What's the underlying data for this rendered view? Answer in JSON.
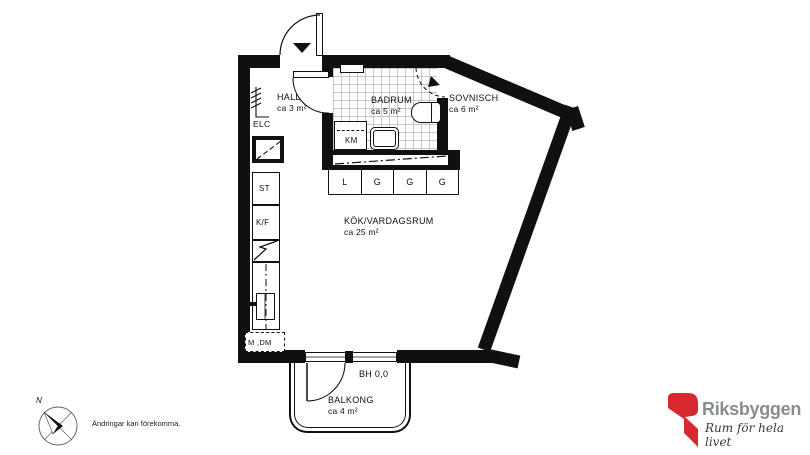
{
  "rooms": {
    "hall": {
      "name": "HALL",
      "area": "ca 3 m²"
    },
    "badrum": {
      "name": "BADRUM",
      "area": "ca 5 m²"
    },
    "sovnisch": {
      "name": "SOVNISCH",
      "area": "ca 6 m²"
    },
    "kok": {
      "name": "KÖK/VARDAGSRUM",
      "area": "ca 25 m²"
    },
    "balkong": {
      "name": "BALKONG",
      "area": "ca 4 m²"
    }
  },
  "fixtures": {
    "elc": "ELC",
    "st": "ST",
    "kf": "K/F",
    "km": "KM",
    "mdm": "M ,DM",
    "bh": "BH 0,0"
  },
  "closets": [
    "L",
    "G",
    "G",
    "G"
  ],
  "compass": {
    "north": "N"
  },
  "footer": {
    "disclaimer": "Ändringar kan förekomma."
  },
  "brand": {
    "name": "Riksbyggen",
    "tagline": "Rum för hela livet",
    "red": "#d7282f",
    "gray": "#8a8d8f",
    "line_color": "#101010"
  }
}
